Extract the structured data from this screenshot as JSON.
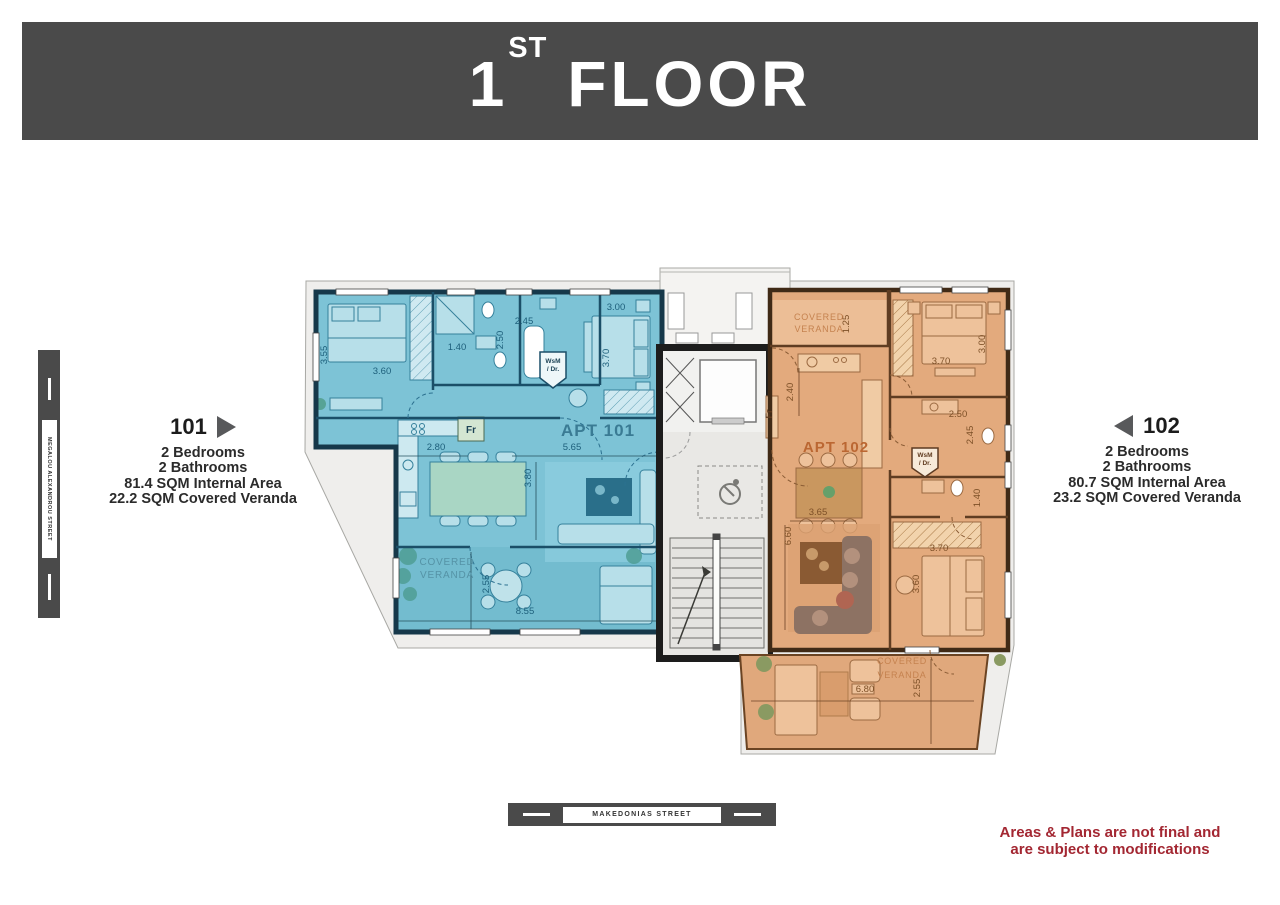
{
  "header": {
    "floor_number": "1",
    "floor_ordinal": "ST",
    "floor_word": "FLOOR"
  },
  "info_101": {
    "number": "101",
    "lines": [
      "2 Bedrooms",
      "2 Bathrooms",
      "81.4 SQM Internal Area",
      "22.2 SQM Covered Veranda"
    ]
  },
  "info_102": {
    "number": "102",
    "lines": [
      "2 Bedrooms",
      "2 Bathrooms",
      "80.7 SQM Internal Area",
      "23.2 SQM Covered Veranda"
    ]
  },
  "streets": {
    "left_vertical": "MEGALOU ALEXANDROU STREET",
    "bottom": "MAKEDONIAS STREET"
  },
  "disclaimer": [
    "Areas & Plans are not final and",
    "are subject to modifications"
  ],
  "colors": {
    "header_bg": "#4a4a4a",
    "disclaimer_red": "#a32732",
    "apt101_fill": "#7dc3d6",
    "apt101_wall": "#16384a",
    "apt102_fill": "#e3aa7d",
    "apt102_wall": "#402a16"
  },
  "plan_labels": [
    {
      "t": "3.55",
      "x": 327,
      "y": 355,
      "r": -90,
      "c": "blue"
    },
    {
      "t": "3.60",
      "x": 382,
      "y": 374,
      "c": "blue"
    },
    {
      "t": "1.40",
      "x": 457,
      "y": 350,
      "c": "blue"
    },
    {
      "t": "2.45",
      "x": 524,
      "y": 324,
      "c": "blue"
    },
    {
      "t": "2.50",
      "x": 503,
      "y": 340,
      "r": -90,
      "c": "blue"
    },
    {
      "t": "3.00",
      "x": 616,
      "y": 310,
      "c": "blue"
    },
    {
      "t": "3.70",
      "x": 609,
      "y": 358,
      "r": -90,
      "c": "blue"
    },
    {
      "t": "2.80",
      "x": 436,
      "y": 450,
      "c": "blue"
    },
    {
      "t": "5.65",
      "x": 572,
      "y": 450,
      "c": "blue"
    },
    {
      "t": "3.80",
      "x": 531,
      "y": 478,
      "r": -90,
      "c": "blue"
    },
    {
      "t": "2.55",
      "x": 489,
      "y": 584,
      "r": -90,
      "c": "blue"
    },
    {
      "t": "8.55",
      "x": 525,
      "y": 614,
      "c": "blue"
    },
    {
      "t": "1.25",
      "x": 849,
      "y": 324,
      "r": -90,
      "c": "orange"
    },
    {
      "t": "2.40",
      "x": 793,
      "y": 392,
      "r": -90,
      "c": "orange"
    },
    {
      "t": "3.70",
      "x": 941,
      "y": 364,
      "c": "orange"
    },
    {
      "t": "3.00",
      "x": 985,
      "y": 344,
      "r": -90,
      "c": "orange"
    },
    {
      "t": "2.50",
      "x": 958,
      "y": 417,
      "c": "orange"
    },
    {
      "t": "2.45",
      "x": 973,
      "y": 435,
      "r": -90,
      "c": "orange"
    },
    {
      "t": "1.40",
      "x": 980,
      "y": 498,
      "r": -90,
      "c": "orange"
    },
    {
      "t": "3.65",
      "x": 818,
      "y": 515,
      "c": "orange"
    },
    {
      "t": "6.60",
      "x": 791,
      "y": 536,
      "r": -90,
      "c": "orange"
    },
    {
      "t": "3.70",
      "x": 939,
      "y": 551,
      "c": "orange"
    },
    {
      "t": "3.60",
      "x": 919,
      "y": 584,
      "r": -90,
      "c": "orange"
    },
    {
      "t": "6.80",
      "x": 865,
      "y": 692,
      "c": "orange"
    },
    {
      "t": "2.55",
      "x": 920,
      "y": 688,
      "r": -90,
      "c": "orange"
    }
  ],
  "room_labels": [
    {
      "t": "APT 101",
      "x": 598,
      "y": 436,
      "c": "blue_apt",
      "size": 17
    },
    {
      "t": "APT 102",
      "x": 836,
      "y": 452,
      "c": "orange_apt",
      "size": 15
    },
    {
      "t": "COVERED",
      "x": 447,
      "y": 565,
      "c": "blue_muted",
      "size": 10
    },
    {
      "t": "VERANDA",
      "x": 447,
      "y": 578,
      "c": "blue_muted",
      "size": 10
    },
    {
      "t": "COVERED",
      "x": 819,
      "y": 320,
      "c": "orange_muted",
      "size": 9
    },
    {
      "t": "VERANDA",
      "x": 819,
      "y": 332,
      "c": "orange_muted",
      "size": 9
    },
    {
      "t": "COVERED",
      "x": 902,
      "y": 664,
      "c": "orange_muted",
      "size": 9
    },
    {
      "t": "VERANDA",
      "x": 902,
      "y": 678,
      "c": "orange_muted",
      "size": 9
    },
    {
      "t": "Fr",
      "x": 471,
      "y": 433,
      "c": "blue_dark",
      "size": 10
    },
    {
      "t": "Fr",
      "x": 772,
      "y": 414,
      "r": -90,
      "c": "orange_dark",
      "size": 9
    },
    {
      "t": "WsM",
      "x": 553,
      "y": 363,
      "c": "blue_dark",
      "size": 6.5
    },
    {
      "t": "/ Dr.",
      "x": 553,
      "y": 371,
      "c": "blue_dark",
      "size": 6.5
    },
    {
      "t": "WsM",
      "x": 925,
      "y": 457,
      "c": "orange_dark",
      "size": 6.5
    },
    {
      "t": "/ Dr.",
      "x": 925,
      "y": 465,
      "c": "orange_dark",
      "size": 6.5
    }
  ]
}
